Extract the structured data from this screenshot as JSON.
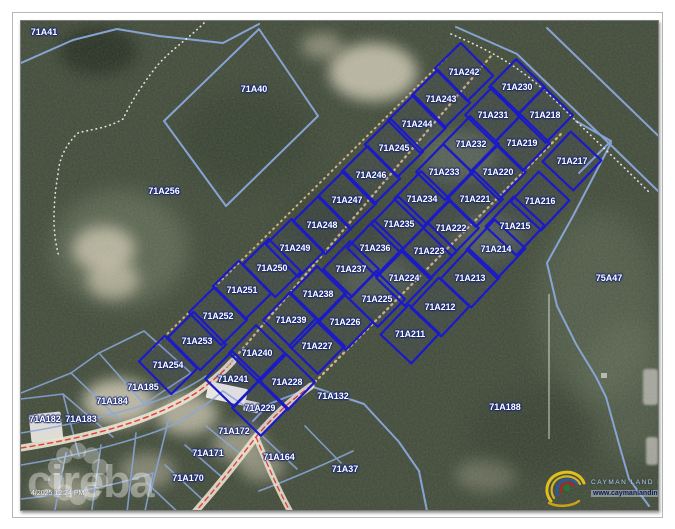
{
  "map": {
    "title": "Cadastral aerial parcel map",
    "timestamp": "4/2025 12:24 PM",
    "subdivision": {
      "boundary_color": "#1b1ac9",
      "columns": [
        {
          "parcels": [
            {
              "id": "71A242",
              "x": 463,
              "y": 71
            },
            {
              "id": "71A243",
              "x": 440,
              "y": 98
            },
            {
              "id": "71A244",
              "x": 416,
              "y": 123
            },
            {
              "id": "71A245",
              "x": 393,
              "y": 147
            },
            {
              "id": "71A246",
              "x": 370,
              "y": 174
            },
            {
              "id": "71A247",
              "x": 346,
              "y": 199
            },
            {
              "id": "71A248",
              "x": 321,
              "y": 224
            },
            {
              "id": "71A249",
              "x": 294,
              "y": 247
            },
            {
              "id": "71A250",
              "x": 271,
              "y": 267
            },
            {
              "id": "71A251",
              "x": 241,
              "y": 289
            },
            {
              "id": "71A252",
              "x": 217,
              "y": 315
            },
            {
              "id": "71A253",
              "x": 196,
              "y": 340
            },
            {
              "id": "71A254",
              "x": 167,
              "y": 364
            }
          ]
        },
        {
          "parcels": [
            {
              "id": "71A230",
              "x": 516,
              "y": 86
            },
            {
              "id": "71A231",
              "x": 492,
              "y": 114
            },
            {
              "id": "71A232",
              "x": 470,
              "y": 143
            },
            {
              "id": "71A233",
              "x": 443,
              "y": 171
            },
            {
              "id": "71A234",
              "x": 421,
              "y": 198
            },
            {
              "id": "71A235",
              "x": 398,
              "y": 223
            },
            {
              "id": "71A236",
              "x": 374,
              "y": 247
            },
            {
              "id": "71A237",
              "x": 350,
              "y": 268
            },
            {
              "id": "71A238",
              "x": 317,
              "y": 293
            },
            {
              "id": "71A239",
              "x": 290,
              "y": 319
            },
            {
              "id": "71A240",
              "x": 256,
              "y": 352
            },
            {
              "id": "71A241",
              "x": 232,
              "y": 378
            }
          ]
        },
        {
          "parcels": [
            {
              "id": "71A218",
              "x": 544,
              "y": 114
            },
            {
              "id": "71A219",
              "x": 521,
              "y": 142
            },
            {
              "id": "71A220",
              "x": 497,
              "y": 171
            },
            {
              "id": "71A221",
              "x": 474,
              "y": 198
            },
            {
              "id": "71A222",
              "x": 450,
              "y": 227
            },
            {
              "id": "71A223",
              "x": 428,
              "y": 250
            },
            {
              "id": "71A224",
              "x": 403,
              "y": 277
            },
            {
              "id": "71A225",
              "x": 376,
              "y": 298
            },
            {
              "id": "71A226",
              "x": 344,
              "y": 321
            },
            {
              "id": "71A227",
              "x": 316,
              "y": 345
            },
            {
              "id": "71A228",
              "x": 286,
              "y": 381
            },
            {
              "id": "71A229",
              "x": 259,
              "y": 407
            }
          ]
        },
        {
          "parcels": [
            {
              "id": "71A217",
              "x": 571,
              "y": 160
            },
            {
              "id": "71A216",
              "x": 539,
              "y": 200
            },
            {
              "id": "71A215",
              "x": 514,
              "y": 225
            },
            {
              "id": "71A214",
              "x": 495,
              "y": 248
            },
            {
              "id": "71A213",
              "x": 469,
              "y": 277
            },
            {
              "id": "71A212",
              "x": 439,
              "y": 306
            },
            {
              "id": "71A211",
              "x": 409,
              "y": 333
            }
          ]
        }
      ]
    },
    "neighbors": [
      {
        "id": "71A41",
        "x": 43,
        "y": 31
      },
      {
        "id": "71A40",
        "x": 253,
        "y": 88
      },
      {
        "id": "71A256",
        "x": 163,
        "y": 190
      },
      {
        "id": "75A47",
        "x": 608,
        "y": 277
      },
      {
        "id": "71A188",
        "x": 504,
        "y": 406
      },
      {
        "id": "71A37",
        "x": 344,
        "y": 468
      },
      {
        "id": "71A132",
        "x": 332,
        "y": 395
      },
      {
        "id": "71A164",
        "x": 278,
        "y": 456
      },
      {
        "id": "71A170",
        "x": 187,
        "y": 477
      },
      {
        "id": "71A171",
        "x": 207,
        "y": 452
      },
      {
        "id": "71A172",
        "x": 233,
        "y": 430
      },
      {
        "id": "71A182",
        "x": 44,
        "y": 418
      },
      {
        "id": "71A183",
        "x": 80,
        "y": 418
      },
      {
        "id": "71A184",
        "x": 111,
        "y": 400
      },
      {
        "id": "71A185",
        "x": 142,
        "y": 386
      }
    ],
    "colors": {
      "subdivision_line": "#1b1ac9",
      "neighbor_line": "#8aa8dc",
      "road_surface": "#ece4d2",
      "road_centerline": "#e23c3c",
      "track_dots": "#cfb288"
    }
  },
  "watermark": {
    "brand": "cireba"
  },
  "logo": {
    "line1": "CAYMAN LAND INFO",
    "line2": "www.caymanlandinfo.ky"
  }
}
